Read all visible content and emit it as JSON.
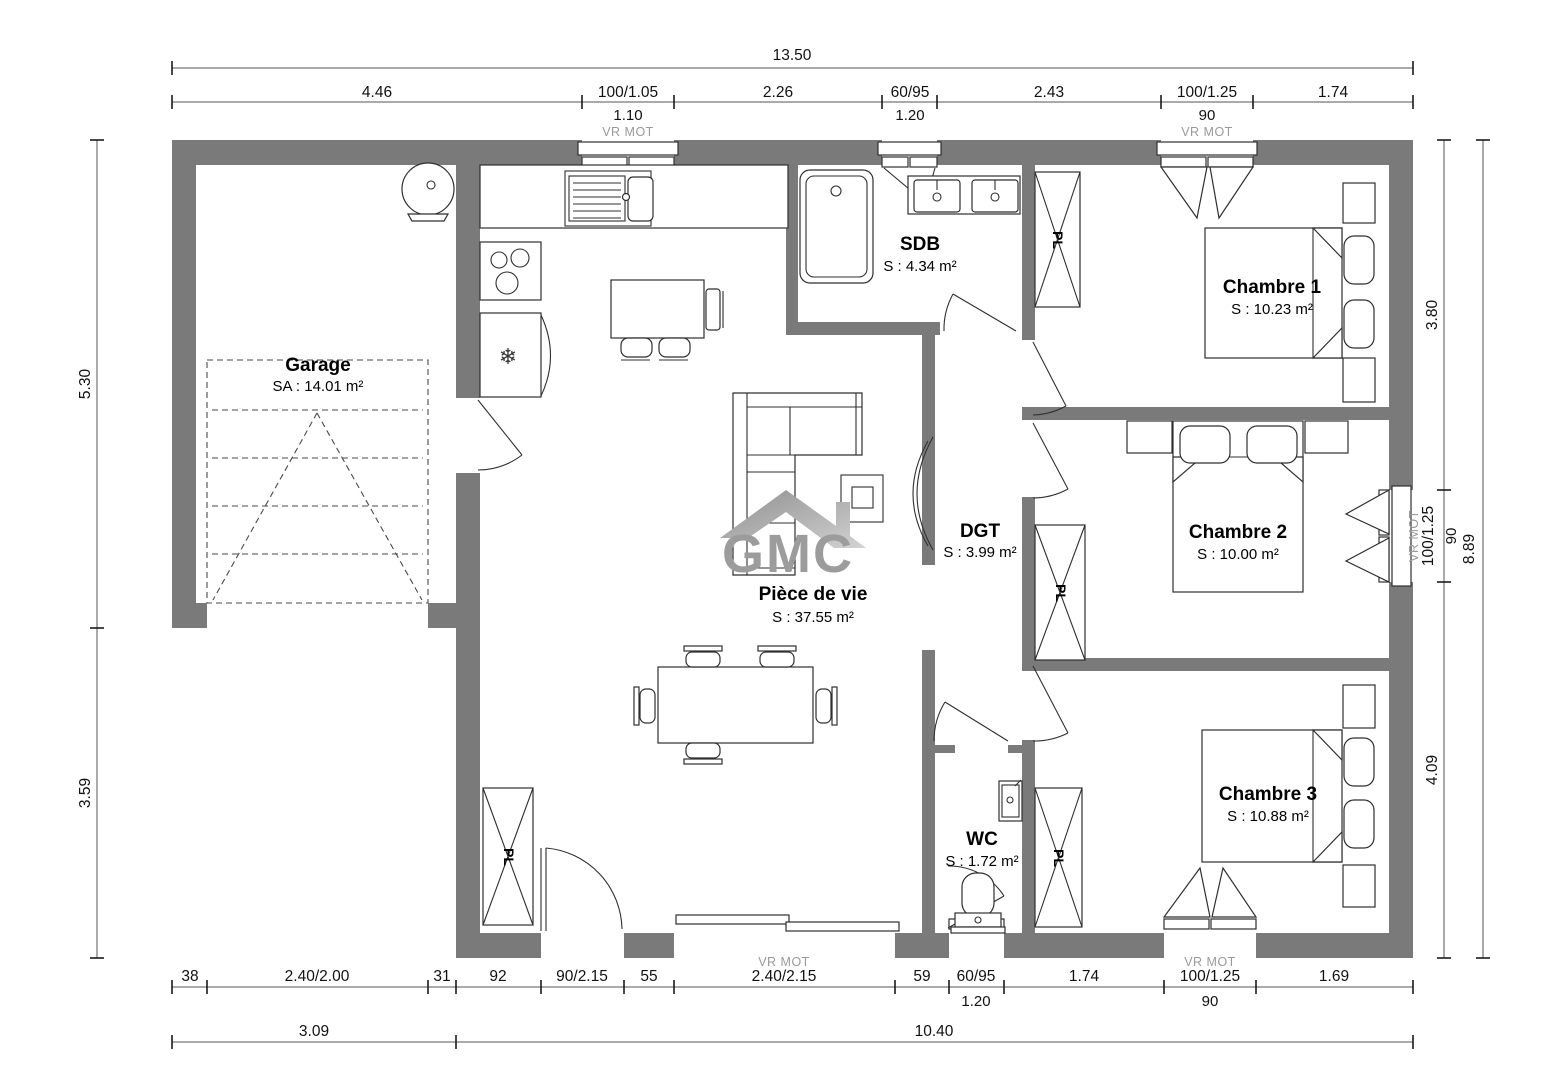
{
  "brand": {
    "logo_text": "GMC"
  },
  "labels": {
    "closet": "PL",
    "shutter": "VR MOT"
  },
  "rooms": {
    "garage": {
      "name": "Garage",
      "area": "SA : 14.01 m²"
    },
    "piece_de_vie": {
      "name": "Pièce de vie",
      "area": "S : 37.55 m²"
    },
    "sdb": {
      "name": "SDB",
      "area": "S : 4.34 m²"
    },
    "dgt": {
      "name": "DGT",
      "area": "S : 3.99 m²"
    },
    "wc": {
      "name": "WC",
      "area": "S : 1.72 m²"
    },
    "chambre1": {
      "name": "Chambre 1",
      "area": "S : 10.23 m²"
    },
    "chambre2": {
      "name": "Chambre 2",
      "area": "S : 10.00 m²"
    },
    "chambre3": {
      "name": "Chambre 3",
      "area": "S : 10.88 m²"
    }
  },
  "dims": {
    "top": {
      "total": "13.50",
      "segments": [
        "4.46",
        "100/1.05",
        "2.26",
        "60/95",
        "2.43",
        "100/1.25",
        "1.74"
      ],
      "subs": [
        "1.10",
        "1.20",
        "90"
      ]
    },
    "bottom": {
      "segments": [
        "38",
        "2.40/2.00",
        "31",
        "92",
        "90/2.15",
        "55",
        "2.40/2.15",
        "59",
        "60/95",
        "1.74",
        "100/1.25",
        "1.69"
      ],
      "subs": [
        "1.20",
        "90"
      ],
      "totals": [
        "3.09",
        "10.40"
      ]
    },
    "left": {
      "segments": [
        "5.30",
        "3.59"
      ]
    },
    "right": {
      "segments": [
        "3.80",
        "100/1.25",
        "4.09"
      ],
      "window_sub": "90",
      "total": "8.89"
    }
  }
}
